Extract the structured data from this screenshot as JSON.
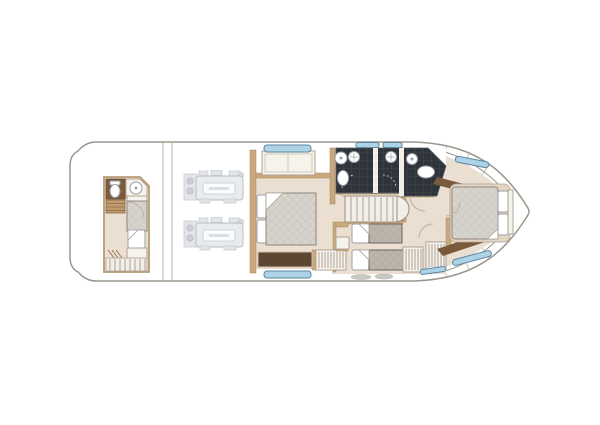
{
  "plan": {
    "orientation": "bow-right",
    "rooms": [
      "crew-cabin-aft",
      "engine-room",
      "master-cabin",
      "mid-shower-port",
      "mid-shower-starboard",
      "staircase-hall",
      "twin-guest-cabin",
      "forward-bathroom",
      "forward-vip-cabin",
      "bow-deck"
    ],
    "fixtures": [
      "crew-toilet",
      "crew-sink",
      "crew-berth",
      "engine-port",
      "engine-starboard",
      "master-double-bed",
      "master-bench",
      "master-wardrobe",
      "shower-head-port",
      "shower-head-starboard",
      "toilet-mid",
      "sink-mid",
      "stairs",
      "twin-bed-upper",
      "twin-bed-lower",
      "nightstand",
      "hanging-locker-1",
      "hanging-locker-2",
      "forward-sink",
      "forward-toilet",
      "vip-island-bed",
      "hull-windows",
      "deck-hatches"
    ],
    "engine_count": 2,
    "engine_label_plate": ""
  },
  "colors": {
    "background": "#ffffff",
    "hull_outline": "#9b968d",
    "floor": "#eadfd1",
    "wall_tan": "#c9a87e",
    "wall_dark_brown": "#7a5a3c",
    "bench_brown": "#5d4733",
    "tile_dark": "#2f333a",
    "tile_grid": "#474c55",
    "window_blue": "#aed3e6",
    "window_frame": "#5b87a0",
    "mattress_gray": "#d6d2cc",
    "mattress_taupe": "#bcb5ac",
    "furniture_white": "#f6f2ec",
    "furniture_stroke": "#b0a294",
    "steps_brown": "#c49a6c",
    "engine_gray": "#e8eaec"
  }
}
